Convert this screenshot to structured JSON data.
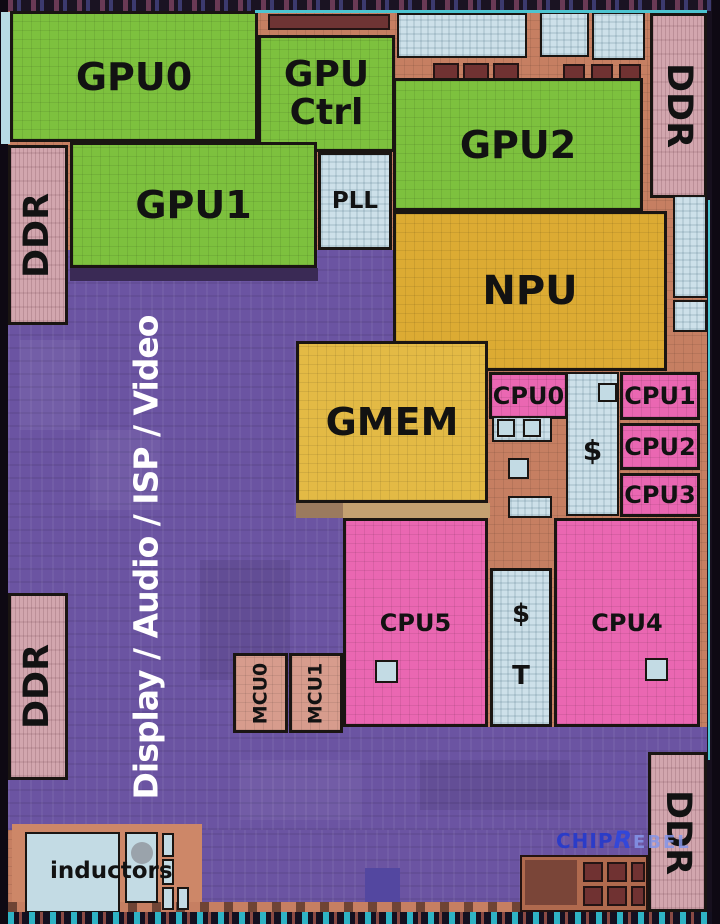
{
  "labels": {
    "gpu0": "GPU0",
    "gpu_ctrl_line1": "GPU",
    "gpu_ctrl_line2": "Ctrl",
    "gpu1": "GPU1",
    "gpu2": "GPU2",
    "pll": "PLL",
    "npu": "NPU",
    "gmem": "GMEM",
    "cpu0": "CPU0",
    "cpu1": "CPU1",
    "cpu2": "CPU2",
    "cpu3": "CPU3",
    "cpu4": "CPU4",
    "cpu5": "CPU5",
    "l2_cache": "$",
    "l3_cache_dollar": "$",
    "l3_cache_t": "T",
    "mcu0": "MCU0",
    "mcu1": "MCU1",
    "ddr": "DDR",
    "media_region": "Display / Audio / ISP / Video",
    "inductors": "inductors"
  },
  "watermark": {
    "chip": "CHIP",
    "rebel_r": "R",
    "rebel_rest": "EBEL"
  },
  "colors": {
    "gpu_green": "#7dc13e",
    "npu_gold": "#dcab33",
    "gmem_gold": "#e3ba45",
    "cpu_pink": "#ea67b2",
    "cache_blue": "#cde0e9",
    "fabric_purple": "#6b54a2",
    "substrate_copper": "#c67f62",
    "ddr_rose": "#d2a6ae",
    "mcu_salmon": "#d79c8d",
    "label_black": "#121212",
    "media_label_white": "#ffffff",
    "watermark_blue": "#2b3cc8",
    "watermark_light_blue": "#8496ea"
  }
}
